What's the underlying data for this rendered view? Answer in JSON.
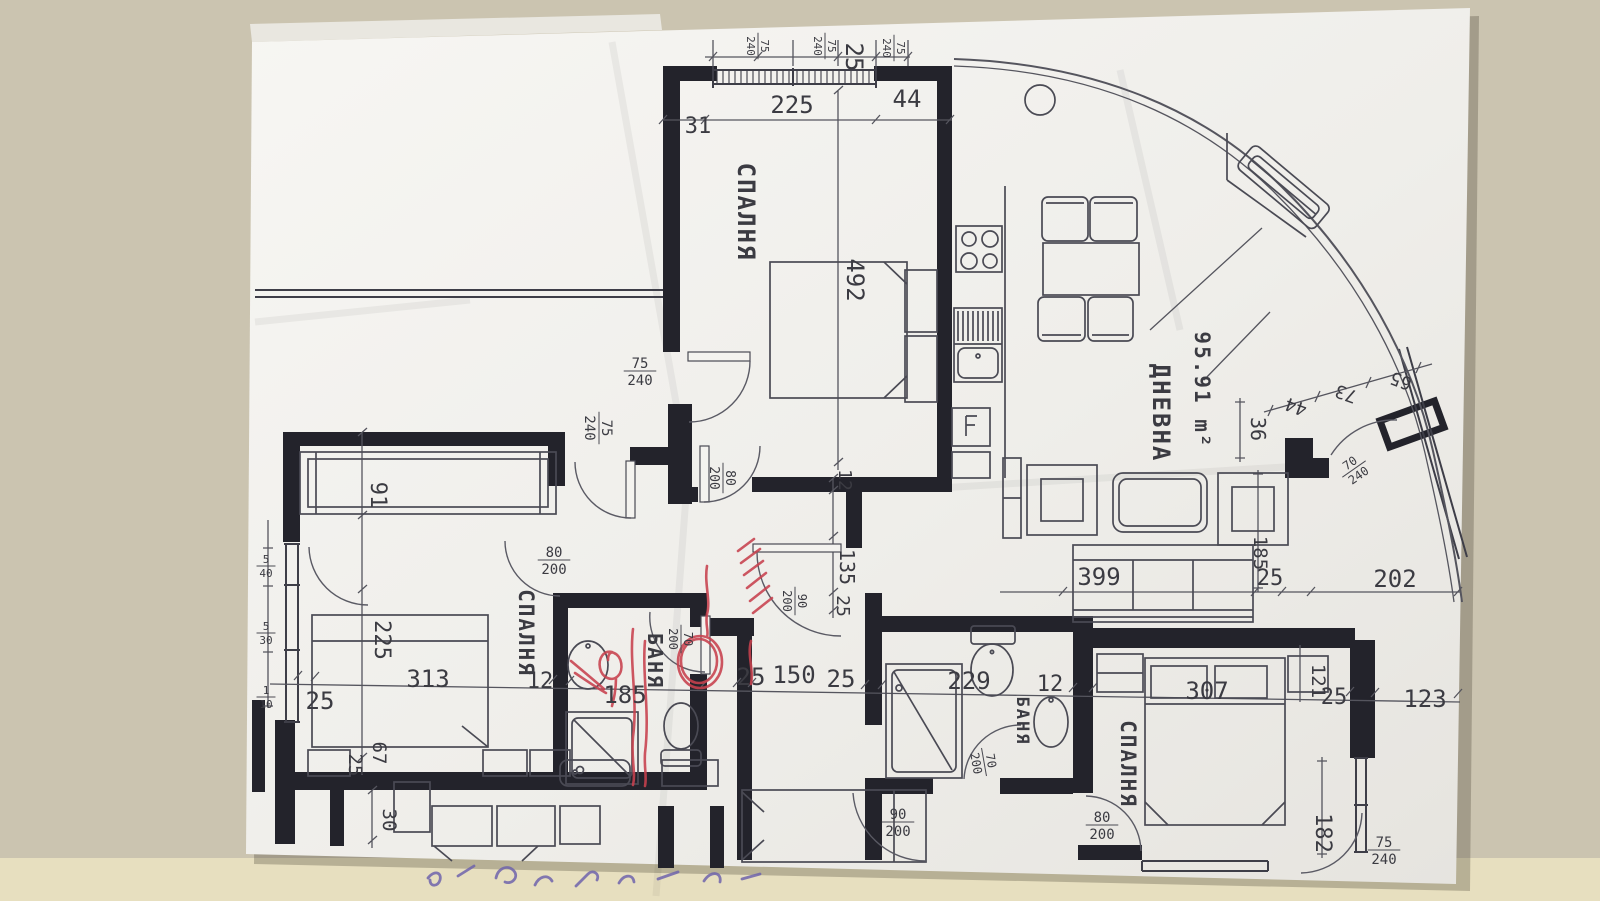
{
  "scene": {
    "background_color": "#cbc4b0",
    "background_strip_color": "#e7dfbf",
    "paper_color": "#f4f3ef",
    "ink_color": "#23232b",
    "line_color": "#55555e",
    "red_pen_color": "#c8414e",
    "blue_pen_color": "#6f64ab"
  },
  "plan": {
    "rooms": [
      {
        "name": "bedroom-1",
        "label": "СПАЛНЯ",
        "x": 738,
        "y": 212,
        "r": 90,
        "s": 24
      },
      {
        "name": "bedroom-2",
        "label": "СПАЛНЯ",
        "x": 519,
        "y": 633,
        "r": 90,
        "s": 21
      },
      {
        "name": "bedroom-3",
        "label": "СПАЛНЯ",
        "x": 1121,
        "y": 764,
        "r": 90,
        "s": 21
      },
      {
        "name": "bathroom-1",
        "label": "БАНЯ",
        "x": 648,
        "y": 661,
        "r": 90,
        "s": 20
      },
      {
        "name": "bathroom-2",
        "label": "БАНЯ",
        "x": 1017,
        "y": 721,
        "r": 90,
        "s": 17
      },
      {
        "name": "living-room",
        "label": "ДНЕВНА",
        "x": 1153,
        "y": 413,
        "r": 90,
        "s": 24
      },
      {
        "name": "living-room-area",
        "label": "95.91 m²",
        "x": 1195,
        "y": 390,
        "r": 90,
        "s": 21
      }
    ],
    "texts": [
      {
        "t": "225",
        "x": 792,
        "y": 113,
        "r": 0,
        "s": 24
      },
      {
        "t": "44",
        "x": 907,
        "y": 107,
        "r": 0,
        "s": 24
      },
      {
        "t": "31",
        "x": 698,
        "y": 133,
        "r": 0,
        "s": 22
      },
      {
        "t": "25",
        "x": 846,
        "y": 57,
        "r": 90,
        "s": 24
      },
      {
        "t": "492",
        "x": 847,
        "y": 280,
        "r": 90,
        "s": 24
      },
      {
        "t": "91",
        "x": 371,
        "y": 495,
        "r": 90,
        "s": 22
      },
      {
        "t": "225",
        "x": 375,
        "y": 640,
        "r": 90,
        "s": 22
      },
      {
        "t": "313",
        "x": 428,
        "y": 687,
        "r": 0,
        "s": 24
      },
      {
        "t": "12",
        "x": 540,
        "y": 688,
        "r": 0,
        "s": 22
      },
      {
        "t": "25",
        "x": 320,
        "y": 709,
        "r": 0,
        "s": 24
      },
      {
        "t": "25",
        "x": 349,
        "y": 765,
        "r": 90,
        "s": 19
      },
      {
        "t": "67",
        "x": 373,
        "y": 753,
        "r": 90,
        "s": 19
      },
      {
        "t": "30",
        "x": 383,
        "y": 820,
        "r": 90,
        "s": 19
      },
      {
        "t": "185",
        "x": 625,
        "y": 703,
        "r": 0,
        "s": 24
      },
      {
        "t": "25",
        "x": 751,
        "y": 685,
        "r": 0,
        "s": 24
      },
      {
        "t": "150",
        "x": 794,
        "y": 683,
        "r": 0,
        "s": 24
      },
      {
        "t": "25",
        "x": 841,
        "y": 687,
        "r": 0,
        "s": 24
      },
      {
        "t": "229",
        "x": 969,
        "y": 689,
        "r": 0,
        "s": 24
      },
      {
        "t": "12",
        "x": 1050,
        "y": 691,
        "r": 0,
        "s": 22
      },
      {
        "t": "307",
        "x": 1207,
        "y": 699,
        "r": 0,
        "s": 24
      },
      {
        "t": "25",
        "x": 1334,
        "y": 704,
        "r": 0,
        "s": 22
      },
      {
        "t": "123",
        "x": 1425,
        "y": 707,
        "r": 0,
        "s": 24
      },
      {
        "t": "121",
        "x": 1312,
        "y": 681,
        "r": 90,
        "s": 19
      },
      {
        "t": "182",
        "x": 1316,
        "y": 833,
        "r": 90,
        "s": 22
      },
      {
        "t": "399",
        "x": 1099,
        "y": 585,
        "r": 0,
        "s": 24
      },
      {
        "t": "25",
        "x": 1270,
        "y": 585,
        "r": 0,
        "s": 22
      },
      {
        "t": "202",
        "x": 1395,
        "y": 587,
        "r": 0,
        "s": 24
      },
      {
        "t": "185",
        "x": 1254,
        "y": 553,
        "r": 90,
        "s": 19
      },
      {
        "t": "12",
        "x": 839,
        "y": 480,
        "r": 90,
        "s": 18
      },
      {
        "t": "135",
        "x": 840,
        "y": 567,
        "r": 90,
        "s": 20
      },
      {
        "t": "25",
        "x": 837,
        "y": 606,
        "r": 90,
        "s": 18
      },
      {
        "t": "36",
        "x": 1251,
        "y": 429,
        "r": 90,
        "s": 20
      },
      {
        "t": "44",
        "x": 1298,
        "y": 401,
        "r": 200,
        "s": 18
      },
      {
        "t": "73",
        "x": 1348,
        "y": 388,
        "r": 200,
        "s": 18
      },
      {
        "t": "65",
        "x": 1403,
        "y": 375,
        "r": 200,
        "s": 18
      }
    ],
    "fractions": [
      {
        "top": "75",
        "bot": "240",
        "x": 758,
        "y": 46,
        "r": 90,
        "s": 11
      },
      {
        "top": "75",
        "bot": "240",
        "x": 825,
        "y": 46,
        "r": 90,
        "s": 11
      },
      {
        "top": "75",
        "bot": "240",
        "x": 894,
        "y": 48,
        "r": 90,
        "s": 11
      },
      {
        "top": "75",
        "bot": "240",
        "x": 640,
        "y": 371,
        "r": 0,
        "s": 14
      },
      {
        "top": "75",
        "bot": "240",
        "x": 599,
        "y": 428,
        "r": 90,
        "s": 14
      },
      {
        "top": "80",
        "bot": "200",
        "x": 723,
        "y": 478,
        "r": 90,
        "s": 13
      },
      {
        "top": "80",
        "bot": "200",
        "x": 554,
        "y": 560,
        "r": 0,
        "s": 14
      },
      {
        "top": "90",
        "bot": "200",
        "x": 795,
        "y": 601,
        "r": 90,
        "s": 12
      },
      {
        "top": "70",
        "bot": "200",
        "x": 681,
        "y": 639,
        "r": 90,
        "s": 12
      },
      {
        "top": "90",
        "bot": "200",
        "x": 898,
        "y": 822,
        "r": 0,
        "s": 14
      },
      {
        "top": "70",
        "bot": "200",
        "x": 984,
        "y": 762,
        "r": 80,
        "s": 12
      },
      {
        "top": "80",
        "bot": "200",
        "x": 1102,
        "y": 825,
        "r": 0,
        "s": 14
      },
      {
        "top": "75",
        "bot": "240",
        "x": 1384,
        "y": 850,
        "r": 0,
        "s": 14
      },
      {
        "top": "70",
        "bot": "240",
        "x": 1354,
        "y": 469,
        "r": -35,
        "s": 12
      },
      {
        "top": "5",
        "bot": "40",
        "x": 266,
        "y": 566,
        "r": 0,
        "s": 11
      },
      {
        "top": "5",
        "bot": "30",
        "x": 266,
        "y": 633,
        "r": 0,
        "s": 11
      },
      {
        "top": "1",
        "bot": "10",
        "x": 266,
        "y": 697,
        "r": 0,
        "s": 11
      }
    ]
  }
}
